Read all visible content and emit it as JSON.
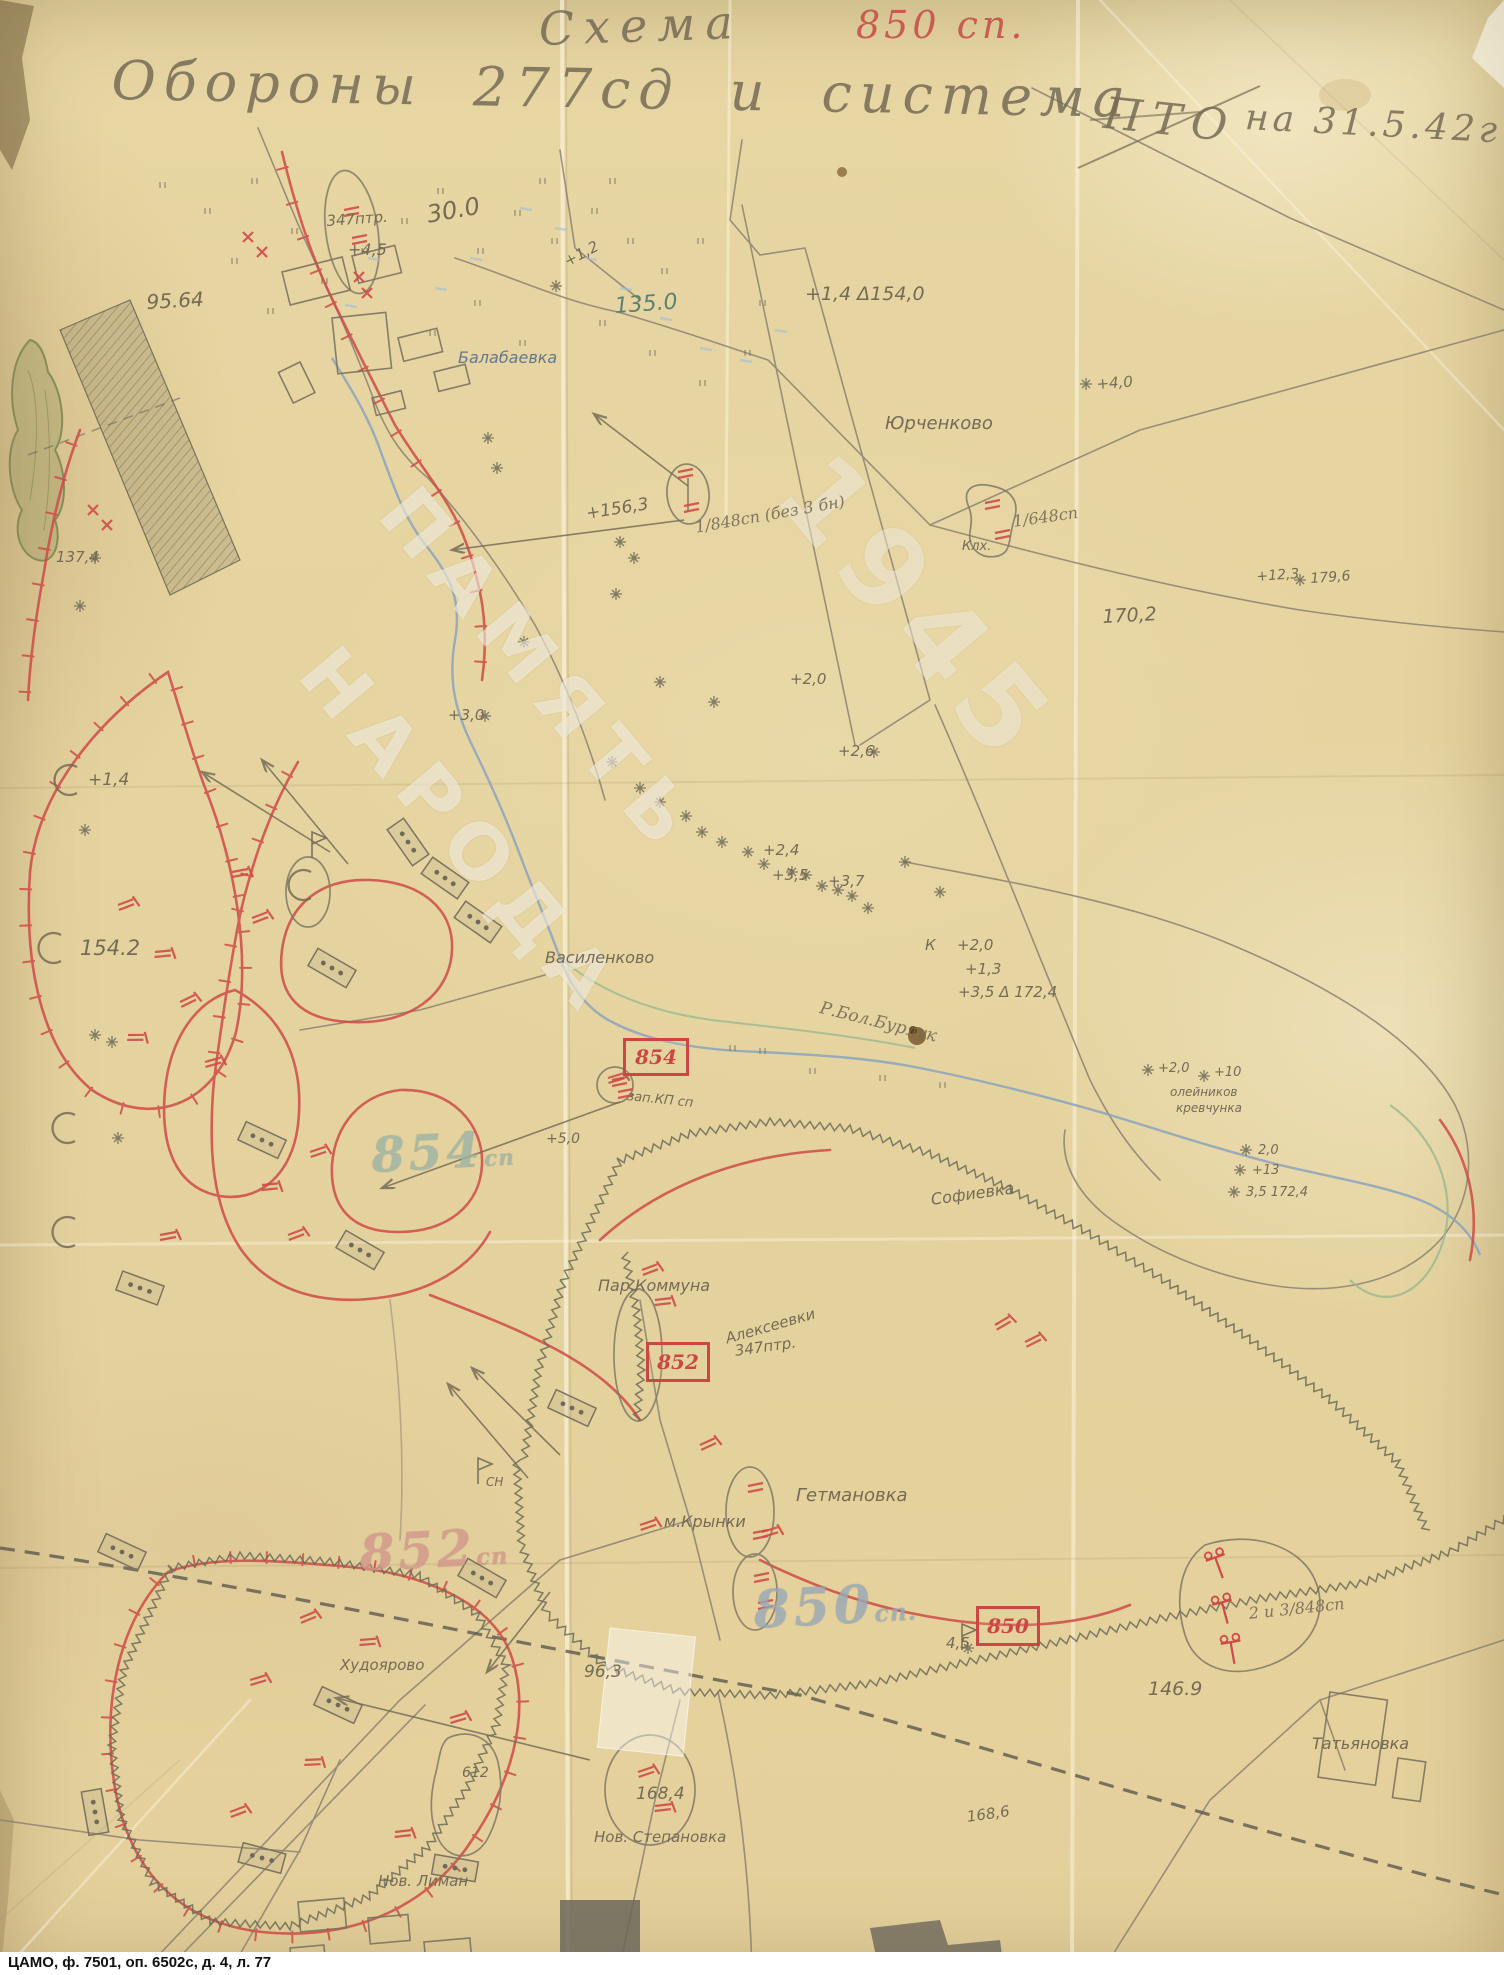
{
  "document": {
    "archive_caption": "ЦАМО, ф. 7501, оп. 6502с, д. 4, л. 77",
    "watermark": [
      "ПАМЯТЬ",
      "НАРОДА",
      "1945"
    ],
    "title": {
      "line1": "Схема",
      "unit_red": "850 сп.",
      "line2": "Обороны 277сд и система",
      "pto": "ПТО",
      "date": "на 31.5.42г"
    }
  },
  "command_post_boxes": [
    {
      "text": "854",
      "x": 623,
      "y": 1038,
      "w": 60,
      "h": 32
    },
    {
      "text": "852",
      "x": 646,
      "y": 1342,
      "w": 58,
      "h": 34
    },
    {
      "text": "850",
      "x": 976,
      "y": 1606,
      "w": 58,
      "h": 34
    }
  ],
  "big_unit_labels": [
    {
      "text": "854",
      "suffix": "сп",
      "x": 370,
      "y": 1128,
      "size": 48,
      "color": "#9cb3a4"
    },
    {
      "text": "852",
      "suffix": "сп",
      "x": 358,
      "y": 1524,
      "size": 50,
      "color": "#d4958b"
    },
    {
      "text": "850",
      "suffix": "сп.",
      "x": 752,
      "y": 1580,
      "size": 52,
      "color": "#97a8ba"
    }
  ],
  "labels": [
    {
      "text": "30.0",
      "x": 425,
      "y": 203,
      "size": 24,
      "color": "p",
      "rot": -10
    },
    {
      "text": "347птр.",
      "x": 326,
      "y": 214,
      "size": 15,
      "color": "p",
      "rot": -4
    },
    {
      "text": "+4,5",
      "x": 348,
      "y": 242,
      "size": 16,
      "color": "p",
      "rot": 0
    },
    {
      "text": "95.64",
      "x": 146,
      "y": 292,
      "size": 20,
      "color": "p",
      "rot": -3
    },
    {
      "text": "Балабаевка",
      "x": 458,
      "y": 350,
      "size": 16,
      "color": "b",
      "rot": 0
    },
    {
      "text": "+1,2",
      "x": 562,
      "y": 256,
      "size": 15,
      "color": "p",
      "rot": -28
    },
    {
      "text": "135.0",
      "x": 614,
      "y": 296,
      "size": 22,
      "color": "t",
      "rot": -4
    },
    {
      "text": "+1,4 Δ154,0",
      "x": 805,
      "y": 285,
      "size": 19,
      "color": "p",
      "rot": 0
    },
    {
      "text": "Юрченково",
      "x": 885,
      "y": 415,
      "size": 18,
      "color": "p",
      "rot": 0
    },
    {
      "text": "+4,0",
      "x": 1096,
      "y": 377,
      "size": 15,
      "color": "p",
      "rot": -4
    },
    {
      "text": "+156,3",
      "x": 585,
      "y": 506,
      "size": 17,
      "color": "p",
      "rot": -9
    },
    {
      "text": "1/848сп (без 3 бн)",
      "x": 694,
      "y": 520,
      "size": 16,
      "color": "p",
      "rot": -10,
      "cls": "hand2"
    },
    {
      "text": "Клх.",
      "x": 962,
      "y": 540,
      "size": 13,
      "color": "p",
      "rot": 0
    },
    {
      "text": "1/648сп",
      "x": 1012,
      "y": 514,
      "size": 16,
      "color": "p",
      "rot": -8,
      "cls": "hand2"
    },
    {
      "text": "+12,3",
      "x": 1256,
      "y": 570,
      "size": 14,
      "color": "p",
      "rot": -4
    },
    {
      "text": "179,6",
      "x": 1310,
      "y": 572,
      "size": 14,
      "color": "p",
      "rot": -4
    },
    {
      "text": "170,2",
      "x": 1102,
      "y": 608,
      "size": 19,
      "color": "p",
      "rot": -3
    },
    {
      "text": "+2,0",
      "x": 790,
      "y": 672,
      "size": 15,
      "color": "p",
      "rot": 0
    },
    {
      "text": "+3,0",
      "x": 448,
      "y": 708,
      "size": 15,
      "color": "p",
      "rot": 0
    },
    {
      "text": "+2,6",
      "x": 838,
      "y": 744,
      "size": 15,
      "color": "p",
      "rot": 0
    },
    {
      "text": "+1,4",
      "x": 88,
      "y": 772,
      "size": 17,
      "color": "p",
      "rot": 0
    },
    {
      "text": "+2,4",
      "x": 763,
      "y": 843,
      "size": 15,
      "color": "p",
      "rot": 0
    },
    {
      "text": "+3,5",
      "x": 772,
      "y": 868,
      "size": 15,
      "color": "p",
      "rot": 0
    },
    {
      "text": "+3,7",
      "x": 828,
      "y": 874,
      "size": 15,
      "color": "p",
      "rot": 0
    },
    {
      "text": "154.2",
      "x": 80,
      "y": 938,
      "size": 21,
      "color": "p",
      "rot": 0
    },
    {
      "text": "Василенково",
      "x": 545,
      "y": 950,
      "size": 16,
      "color": "p",
      "rot": 0
    },
    {
      "text": "К",
      "x": 925,
      "y": 938,
      "size": 15,
      "color": "p",
      "rot": 0
    },
    {
      "text": "+2,0",
      "x": 957,
      "y": 938,
      "size": 15,
      "color": "p",
      "rot": 0
    },
    {
      "text": "+1,3",
      "x": 965,
      "y": 962,
      "size": 15,
      "color": "p",
      "rot": 0
    },
    {
      "text": "+3,5 Δ 172,4",
      "x": 958,
      "y": 985,
      "size": 15,
      "color": "p",
      "rot": 0
    },
    {
      "text": "зап.КП сп",
      "x": 628,
      "y": 1090,
      "size": 13,
      "color": "p",
      "rot": 6
    },
    {
      "text": "Р.Бол.Бурлук",
      "x": 822,
      "y": 1000,
      "size": 17,
      "color": "p",
      "rot": 14,
      "cls": "hand2"
    },
    {
      "text": "+5,0",
      "x": 546,
      "y": 1132,
      "size": 14,
      "color": "p",
      "rot": 0
    },
    {
      "text": "олейников",
      "x": 1170,
      "y": 1086,
      "size": 12,
      "color": "p",
      "rot": 0
    },
    {
      "text": "кревчунка",
      "x": 1176,
      "y": 1102,
      "size": 12,
      "color": "p",
      "rot": 0
    },
    {
      "text": "+2,0",
      "x": 1158,
      "y": 1062,
      "size": 13,
      "color": "p",
      "rot": 0
    },
    {
      "text": "+10",
      "x": 1214,
      "y": 1066,
      "size": 13,
      "color": "p",
      "rot": 0
    },
    {
      "text": "2,0",
      "x": 1258,
      "y": 1144,
      "size": 13,
      "color": "p",
      "rot": 0
    },
    {
      "text": "+13",
      "x": 1252,
      "y": 1164,
      "size": 13,
      "color": "p",
      "rot": 0
    },
    {
      "text": "3,5 172,4",
      "x": 1246,
      "y": 1186,
      "size": 13,
      "color": "p",
      "rot": 0
    },
    {
      "text": "Софиевка",
      "x": 930,
      "y": 1192,
      "size": 16,
      "color": "p",
      "rot": -8
    },
    {
      "text": "Пар.Коммуна",
      "x": 598,
      "y": 1278,
      "size": 16,
      "color": "p",
      "rot": 0
    },
    {
      "text": "Алексеевки",
      "x": 724,
      "y": 1332,
      "size": 15,
      "color": "p",
      "rot": -16
    },
    {
      "text": "347птр.",
      "x": 734,
      "y": 1344,
      "size": 15,
      "color": "p",
      "rot": -8
    },
    {
      "text": "СН",
      "x": 486,
      "y": 1476,
      "size": 12,
      "color": "p",
      "rot": 0
    },
    {
      "text": "м.Крынки",
      "x": 664,
      "y": 1514,
      "size": 16,
      "color": "p",
      "rot": 0
    },
    {
      "text": "Гетмановка",
      "x": 796,
      "y": 1487,
      "size": 18,
      "color": "p",
      "rot": 0
    },
    {
      "text": "Худоярово",
      "x": 340,
      "y": 1658,
      "size": 15,
      "color": "p",
      "rot": 0
    },
    {
      "text": "96,3",
      "x": 584,
      "y": 1664,
      "size": 17,
      "color": "p",
      "rot": 0
    },
    {
      "text": "4,5",
      "x": 946,
      "y": 1636,
      "size": 15,
      "color": "p",
      "rot": 0
    },
    {
      "text": "2 и 3/848сп",
      "x": 1248,
      "y": 1606,
      "size": 16,
      "color": "p",
      "rot": -6,
      "cls": "hand2"
    },
    {
      "text": "146.9",
      "x": 1148,
      "y": 1680,
      "size": 19,
      "color": "p",
      "rot": 0
    },
    {
      "text": "Татьяновка",
      "x": 1312,
      "y": 1736,
      "size": 16,
      "color": "p",
      "rot": 0
    },
    {
      "text": "612",
      "x": 462,
      "y": 1766,
      "size": 14,
      "color": "p",
      "rot": 0
    },
    {
      "text": "168,4",
      "x": 636,
      "y": 1786,
      "size": 17,
      "color": "p",
      "rot": 0
    },
    {
      "text": "168,6",
      "x": 966,
      "y": 1810,
      "size": 15,
      "color": "p",
      "rot": -8
    },
    {
      "text": "Нов. Степановка",
      "x": 594,
      "y": 1830,
      "size": 15,
      "color": "p",
      "rot": 0
    },
    {
      "text": "Нов. Лиман",
      "x": 378,
      "y": 1874,
      "size": 15,
      "color": "p",
      "rot": 0
    },
    {
      "text": "137,4",
      "x": 56,
      "y": 550,
      "size": 15,
      "color": "p",
      "rot": 0
    }
  ],
  "map_symbols": {
    "stars": [
      [
        556,
        286
      ],
      [
        488,
        438
      ],
      [
        497,
        468
      ],
      [
        620,
        542
      ],
      [
        634,
        558
      ],
      [
        616,
        594
      ],
      [
        524,
        642
      ],
      [
        660,
        682
      ],
      [
        714,
        702
      ],
      [
        612,
        762
      ],
      [
        640,
        788
      ],
      [
        660,
        802
      ],
      [
        686,
        816
      ],
      [
        702,
        832
      ],
      [
        722,
        842
      ],
      [
        748,
        852
      ],
      [
        764,
        864
      ],
      [
        792,
        872
      ],
      [
        822,
        886
      ],
      [
        852,
        896
      ],
      [
        868,
        908
      ],
      [
        838,
        890
      ],
      [
        1086,
        384
      ],
      [
        1300,
        580
      ],
      [
        1246,
        1150
      ],
      [
        1240,
        1170
      ],
      [
        1234,
        1192
      ],
      [
        1148,
        1070
      ],
      [
        1204,
        1076
      ],
      [
        968,
        1648
      ],
      [
        806,
        875
      ],
      [
        485,
        716
      ],
      [
        874,
        752
      ],
      [
        95,
        558
      ],
      [
        80,
        606
      ],
      [
        112,
        1042
      ],
      [
        118,
        1138
      ],
      [
        85,
        830
      ],
      [
        95,
        1035
      ],
      [
        905,
        862
      ],
      [
        940,
        892
      ]
    ],
    "crescents": [
      [
        68,
        780
      ],
      [
        52,
        948
      ],
      [
        66,
        1128
      ],
      [
        66,
        1232
      ],
      [
        302,
        885
      ]
    ],
    "flags": [
      [
        312,
        858
      ],
      [
        478,
        1484
      ],
      [
        962,
        1650
      ]
    ],
    "machine_guns": [
      [
        118,
        905,
        -10
      ],
      [
        155,
        952,
        5
      ],
      [
        180,
        1002,
        -15
      ],
      [
        128,
        1035,
        10
      ],
      [
        205,
        1062,
        -5
      ],
      [
        232,
        872,
        0
      ],
      [
        252,
        918,
        -10
      ],
      [
        262,
        1185,
        5
      ],
      [
        288,
        1235,
        -10
      ],
      [
        160,
        1235,
        0
      ],
      [
        310,
        1152,
        -8
      ],
      [
        300,
        1618,
        -12
      ],
      [
        360,
        1640,
        6
      ],
      [
        250,
        1680,
        -6
      ],
      [
        305,
        1760,
        8
      ],
      [
        230,
        1812,
        -10
      ],
      [
        395,
        1832,
        4
      ],
      [
        450,
        1718,
        -6
      ],
      [
        640,
        1525,
        -8
      ],
      [
        700,
        1445,
        -14
      ],
      [
        762,
        1532,
        -6
      ],
      [
        642,
        1270,
        -10
      ],
      [
        655,
        1300,
        4
      ],
      [
        608,
        1078,
        -6
      ],
      [
        995,
        1325,
        -20
      ],
      [
        1025,
        1342,
        -16
      ],
      [
        638,
        1772,
        -8
      ],
      [
        655,
        1806,
        4
      ]
    ],
    "at_guns": [
      [
        1218,
        1565,
        -20
      ],
      [
        1224,
        1610,
        -15
      ],
      [
        1232,
        1650,
        -10
      ]
    ],
    "red_crosses": [
      [
        243,
        232
      ],
      [
        257,
        247
      ],
      [
        88,
        505
      ],
      [
        102,
        520
      ],
      [
        354,
        272
      ],
      [
        362,
        288
      ]
    ],
    "red_bars": [
      [
        344,
        210
      ],
      [
        352,
        238
      ],
      [
        678,
        472
      ],
      [
        684,
        506
      ],
      [
        985,
        503
      ],
      [
        995,
        533
      ],
      [
        748,
        1486
      ],
      [
        753,
        1533
      ],
      [
        754,
        1576
      ],
      [
        758,
        1603
      ],
      [
        612,
        1080
      ],
      [
        618,
        1092
      ]
    ],
    "artillery_positions": [
      [
        445,
        878,
        35
      ],
      [
        478,
        922,
        35
      ],
      [
        408,
        842,
        55
      ],
      [
        332,
        968,
        30
      ],
      [
        262,
        1140,
        25
      ],
      [
        360,
        1250,
        30
      ],
      [
        140,
        1288,
        20
      ],
      [
        572,
        1408,
        25
      ],
      [
        482,
        1578,
        30
      ],
      [
        122,
        1552,
        25
      ],
      [
        95,
        1812,
        80
      ],
      [
        262,
        1858,
        15
      ],
      [
        455,
        1868,
        10
      ],
      [
        338,
        1705,
        25
      ]
    ],
    "fire_arrows": [
      [
        330,
        852,
        202,
        772
      ],
      [
        348,
        864,
        262,
        760
      ],
      [
        688,
        486,
        594,
        414
      ],
      [
        684,
        520,
        452,
        550
      ],
      [
        620,
        1102,
        382,
        1188
      ],
      [
        528,
        1478,
        448,
        1384
      ],
      [
        560,
        1455,
        472,
        1368
      ],
      [
        550,
        1592,
        487,
        1672
      ],
      [
        590,
        1760,
        336,
        1698
      ]
    ]
  }
}
